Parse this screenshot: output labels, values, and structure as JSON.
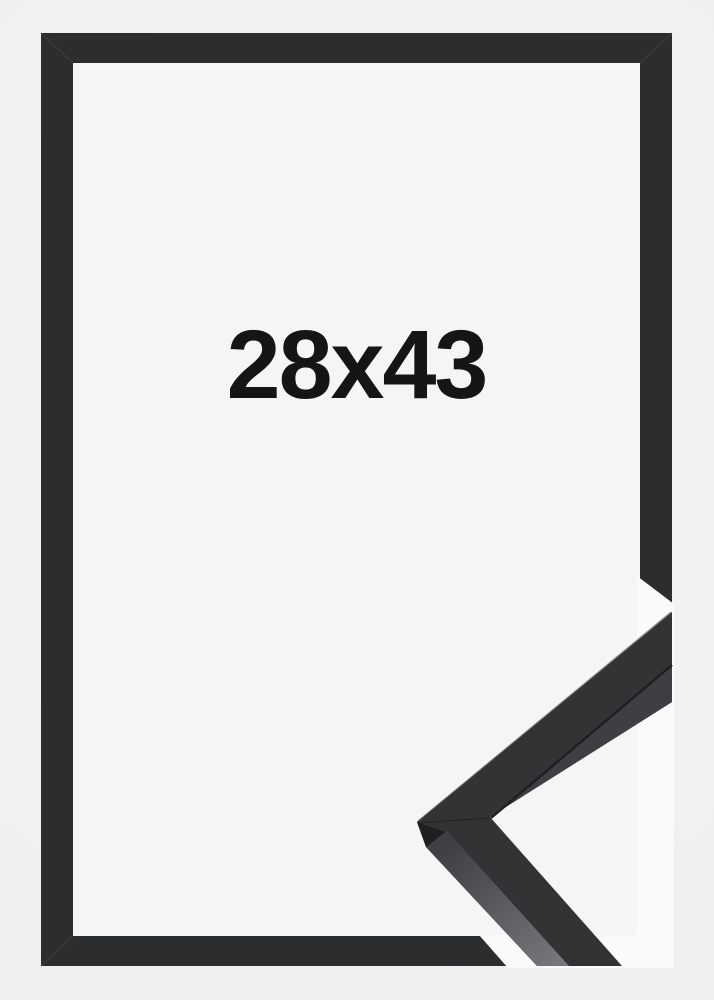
{
  "product": {
    "size_label": "28x43"
  },
  "colors": {
    "background": "#f1f1f2",
    "backing": "#f5f5f6",
    "halo": "#fafafb",
    "frame": "#2c2d2f",
    "frame_seam": "#46474a",
    "sample_face": "#323335",
    "sample_inner_face": "#3e3f42",
    "sample_edge_dark": "#1e1f21",
    "sample_side_dark": "#3f4043",
    "sample_side_light": "#77787b",
    "edge_highlight": "#4d4e51",
    "label_text": "#151517"
  }
}
